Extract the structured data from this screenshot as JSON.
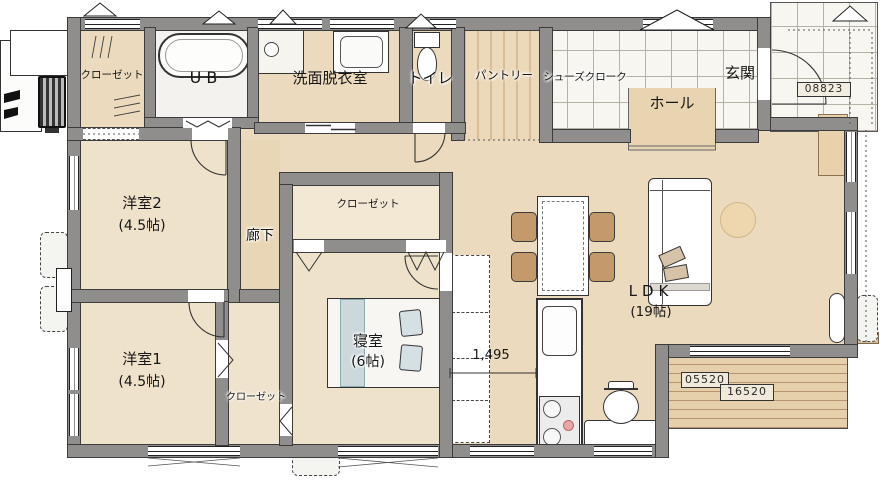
{
  "rooms": {
    "closet_nw": {
      "label": "クローゼット"
    },
    "ub": {
      "label": "UB"
    },
    "washroom": {
      "label": "洗面脱衣室"
    },
    "toilet": {
      "label": "トイレ"
    },
    "pantry": {
      "label": "パントリー"
    },
    "shoes_cloak": {
      "label": "シューズクローク"
    },
    "genkan": {
      "label": "玄関"
    },
    "hall": {
      "label": "ホール"
    },
    "youshitsu2": {
      "label": "洋室2",
      "size": "(4.5帖)"
    },
    "corridor": {
      "label": "廊下"
    },
    "bedroom_closet": {
      "label": "クローゼット"
    },
    "bedroom": {
      "label": "寝室",
      "size": "(6帖)"
    },
    "youshitsu1": {
      "label": "洋室1",
      "size": "(4.5帖)"
    },
    "south_closet": {
      "label": "クローゼット"
    },
    "ldk": {
      "label": "LDK",
      "size": "(19帖)"
    }
  },
  "dimensions": {
    "kitchen_pass": "1,495",
    "deck_stamp_a": "05520",
    "deck_stamp_b": "16520",
    "porch_stamp": "08823"
  },
  "colors": {
    "wall": "#8f8e8c",
    "floor": "#ebdabd",
    "tile": "#f7f6f1",
    "deck": "#e6cfab",
    "fixture": "#ffffff"
  }
}
